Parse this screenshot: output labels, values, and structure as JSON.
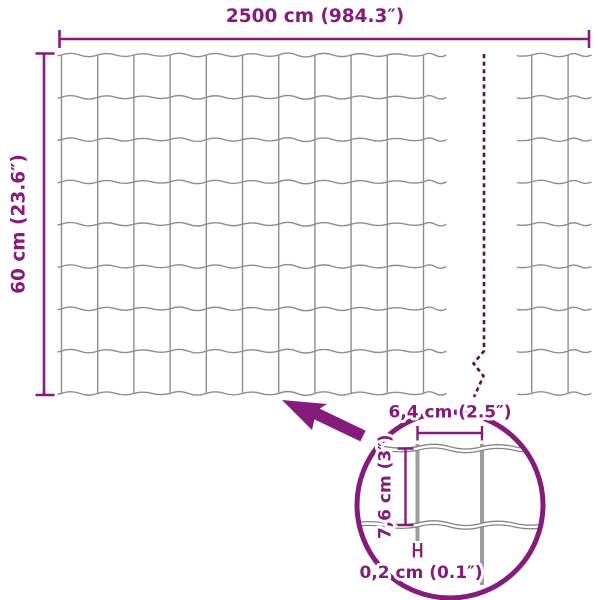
{
  "diagram": {
    "type": "fence-mesh-dimension-diagram",
    "background": "#ffffff",
    "colors": {
      "accent": "#851c7b",
      "dash": "#5c1043",
      "mesh_line": "#8e8e8e",
      "detail_wire": "#9d9d9d",
      "detail_mesh_line": "#858585"
    },
    "labels": {
      "total_width": "2500 cm (984.3″)",
      "total_height": "60 cm (23.6″)",
      "cell_width": "6,4 cm (2.5″)",
      "cell_height": "7,6 cm (3″)",
      "wire_thickness": "0,2 cm (0.1″)"
    },
    "mesh": {
      "horizontal_lines": 9,
      "main_vertical_lines": 11,
      "right_vertical_lines": 2,
      "rows": 8
    }
  }
}
